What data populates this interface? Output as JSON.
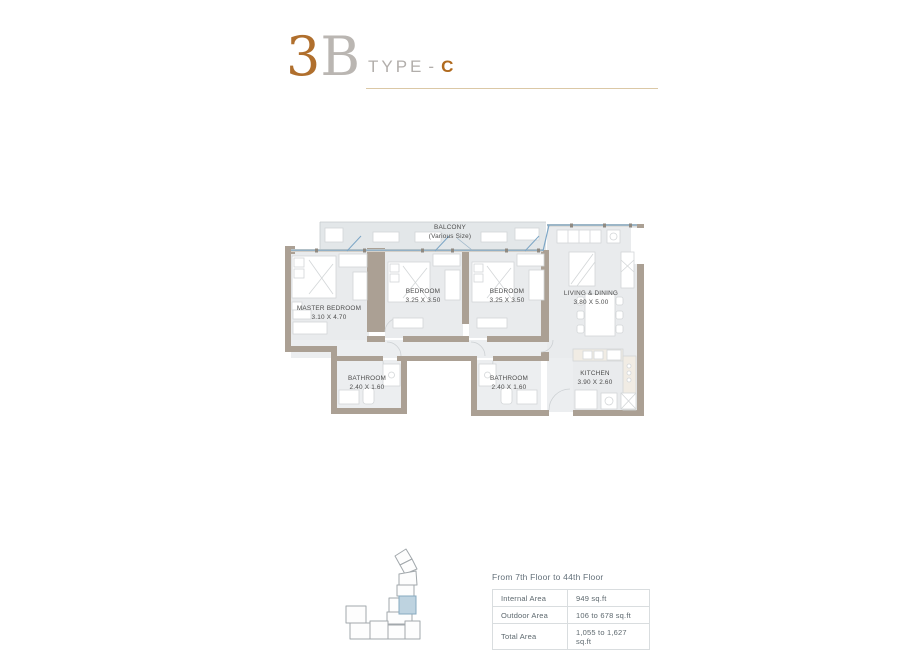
{
  "header": {
    "unit_number": "3",
    "unit_letter": "B",
    "type_label": "TYPE",
    "type_separator": "-",
    "type_value": "C"
  },
  "floorplan": {
    "balcony": {
      "name": "BALCONY",
      "size": "(Various Size)"
    },
    "rooms": [
      {
        "id": "master-bedroom",
        "name": "MASTER BEDROOM",
        "dims": "3.10 X 4.70"
      },
      {
        "id": "bedroom-1",
        "name": "BEDROOM",
        "dims": "3.25 X 3.50"
      },
      {
        "id": "bedroom-2",
        "name": "BEDROOM",
        "dims": "3.25 X 3.50"
      },
      {
        "id": "living-dining",
        "name": "LIVING & DINING",
        "dims": "3.80 X 5.00"
      },
      {
        "id": "kitchen",
        "name": "KITCHEN",
        "dims": "3.90 X 2.60"
      },
      {
        "id": "bathroom-1",
        "name": "BATHROOM",
        "dims": "2.40 X 1.60"
      },
      {
        "id": "bathroom-2",
        "name": "BATHROOM",
        "dims": "2.40 X 1.60"
      }
    ],
    "colors": {
      "wall": "#aba094",
      "floor": "#e9ebed",
      "glass": "#7ca6c6",
      "accent": "#b06f2d",
      "keyplan_highlight": "#bed3e0"
    }
  },
  "details": {
    "floors_note": "From 7th Floor to 44th Floor",
    "rows": [
      {
        "label": "Internal Area",
        "value": "949 sq.ft"
      },
      {
        "label": "Outdoor Area",
        "value": "106 to 678 sq.ft"
      },
      {
        "label": "Total Area",
        "value": "1,055 to 1,627 sq.ft"
      }
    ]
  }
}
